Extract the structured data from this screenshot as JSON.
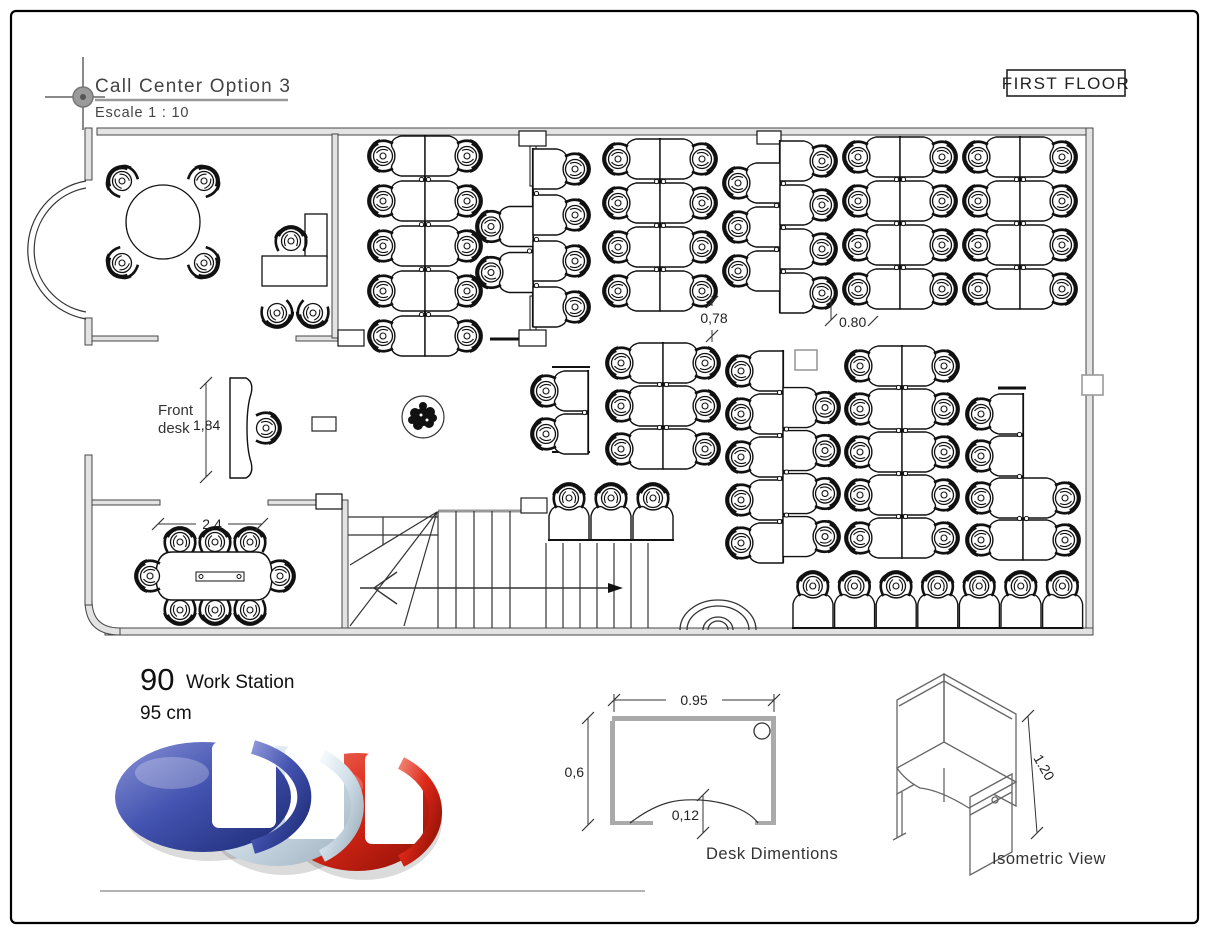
{
  "title_block": {
    "title": "Call Center Option 3",
    "scale": "Escale 1 : 10"
  },
  "floor_label": "FIRST FLOOR",
  "plan": {
    "front_desk_label_line1": "Front",
    "front_desk_label_line2": "desk",
    "dims": {
      "front_desk": "1,84",
      "conference": "2,4",
      "gap_left": "0,78",
      "gap_right": "0.80"
    }
  },
  "summary": {
    "count": "90",
    "label": "Work Station",
    "height": "95 cm"
  },
  "desk_diagram": {
    "caption": "Desk Dimentions",
    "width": "0.95",
    "depth": "0,6",
    "cutout": "0,12"
  },
  "iso": {
    "caption": "Isometric View",
    "height": "1.20"
  },
  "logo": {
    "letters": "CCC",
    "colors": {
      "blue": "#3a49a0",
      "silver": "#c9d6e2",
      "red": "#d42818"
    }
  },
  "workstations": {
    "total": 90,
    "clusters": [
      {
        "kind": "column",
        "divider_x": 425,
        "y0": 135,
        "pitch": 45,
        "left": {
          "n": 5,
          "off": 0
        },
        "right": {
          "n": 5,
          "off": 0
        }
      },
      {
        "kind": "column",
        "divider_x": 533,
        "y0": 148,
        "pitch": 46,
        "left": {
          "n": 2,
          "off": 1.25
        },
        "right": {
          "n": 4,
          "off": 0
        }
      },
      {
        "kind": "column",
        "divider_x": 660,
        "y0": 138,
        "pitch": 44,
        "left": {
          "n": 4,
          "off": 0
        },
        "right": {
          "n": 4,
          "off": 0
        }
      },
      {
        "kind": "column",
        "divider_x": 780,
        "y0": 140,
        "pitch": 44,
        "left": {
          "n": 3,
          "off": 0.5
        },
        "right": {
          "n": 4,
          "off": 0
        }
      },
      {
        "kind": "column",
        "divider_x": 900,
        "y0": 136,
        "pitch": 44,
        "left": {
          "n": 4,
          "off": 0
        },
        "right": {
          "n": 4,
          "off": 0
        }
      },
      {
        "kind": "column",
        "divider_x": 1020,
        "y0": 136,
        "pitch": 44,
        "left": {
          "n": 4,
          "off": 0
        },
        "right": {
          "n": 4,
          "off": 0
        }
      },
      {
        "kind": "column",
        "divider_x": 588,
        "y0": 370,
        "pitch": 43,
        "left": {
          "n": 2,
          "off": 0
        },
        "right": {
          "n": 0,
          "off": 0
        }
      },
      {
        "kind": "column",
        "divider_x": 663,
        "y0": 342,
        "pitch": 43,
        "left": {
          "n": 3,
          "off": 0
        },
        "right": {
          "n": 3,
          "off": 0
        }
      },
      {
        "kind": "column",
        "divider_x": 783,
        "y0": 350,
        "pitch": 43,
        "left": {
          "n": 5,
          "off": 0
        },
        "right": {
          "n": 4,
          "off": 0.85
        }
      },
      {
        "kind": "column",
        "divider_x": 902,
        "y0": 345,
        "pitch": 43,
        "left": {
          "n": 5,
          "off": 0
        },
        "right": {
          "n": 5,
          "off": 0
        }
      },
      {
        "kind": "column",
        "divider_x": 1023,
        "y0": 393,
        "pitch": 42,
        "left": {
          "n": 4,
          "off": 0
        },
        "right": {
          "n": 2,
          "off": 2
        }
      },
      {
        "kind": "row",
        "x0": 548,
        "baseline_y": 540,
        "cell": 42,
        "n": 3
      },
      {
        "kind": "row",
        "x0": 792,
        "baseline_y": 628,
        "cell": 41.6,
        "n": 7
      }
    ]
  }
}
